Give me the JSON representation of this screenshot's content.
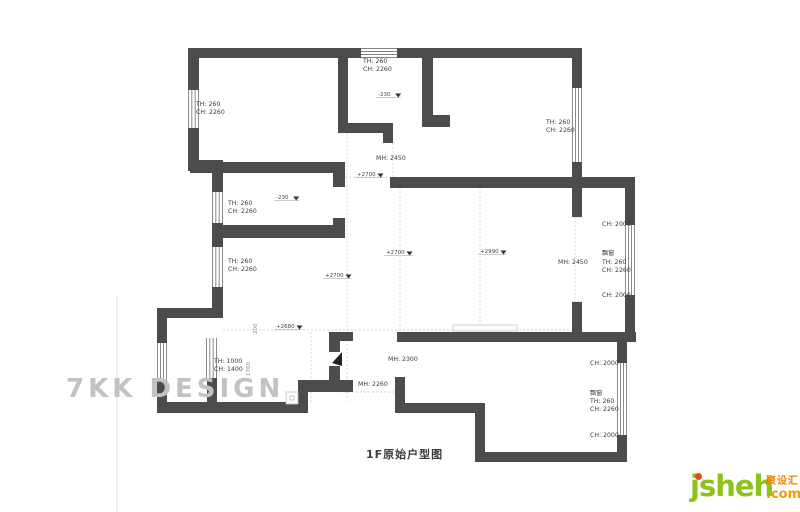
{
  "watermark": {
    "text": "7KK DESIGN"
  },
  "title": {
    "text": "1F原始户型图"
  },
  "logo": {
    "wordmark": "jsheh",
    "chinese": "聚设汇",
    "tld": ".com"
  },
  "floorplan": {
    "wall_color": "#4c4c4c",
    "walls": [
      [
        188,
        48,
        174,
        10
      ],
      [
        396,
        48,
        186,
        10
      ],
      [
        188,
        58,
        11,
        32
      ],
      [
        188,
        128,
        11,
        42
      ],
      [
        188,
        160,
        35,
        11
      ],
      [
        212,
        171,
        11,
        21
      ],
      [
        212,
        223,
        11,
        24
      ],
      [
        212,
        287,
        11,
        31
      ],
      [
        157,
        308,
        66,
        10
      ],
      [
        157,
        318,
        10,
        25
      ],
      [
        157,
        380,
        10,
        33
      ],
      [
        157,
        402,
        151,
        11
      ],
      [
        207,
        378,
        10,
        24
      ],
      [
        298,
        380,
        10,
        33
      ],
      [
        298,
        380,
        55,
        12
      ],
      [
        329,
        332,
        11,
        20
      ],
      [
        329,
        366,
        11,
        26
      ],
      [
        329,
        332,
        24,
        9
      ],
      [
        390,
        177,
        245,
        11
      ],
      [
        397,
        332,
        220,
        10
      ],
      [
        395,
        377,
        10,
        33
      ],
      [
        395,
        403,
        90,
        10
      ],
      [
        475,
        403,
        10,
        59
      ],
      [
        475,
        452,
        152,
        10
      ],
      [
        617,
        342,
        10,
        21
      ],
      [
        617,
        435,
        10,
        27
      ],
      [
        625,
        188,
        10,
        37
      ],
      [
        625,
        295,
        10,
        47
      ],
      [
        617,
        332,
        19,
        10
      ],
      [
        572,
        58,
        10,
        30
      ],
      [
        572,
        162,
        10,
        26
      ],
      [
        572,
        188,
        10,
        29
      ],
      [
        572,
        302,
        10,
        30
      ],
      [
        338,
        55,
        10,
        68
      ],
      [
        338,
        123,
        55,
        10
      ],
      [
        383,
        133,
        10,
        10
      ],
      [
        422,
        58,
        11,
        69
      ],
      [
        422,
        115,
        28,
        12
      ],
      [
        190,
        162,
        155,
        11
      ],
      [
        215,
        225,
        130,
        13
      ],
      [
        333,
        173,
        12,
        14
      ],
      [
        333,
        218,
        12,
        20
      ]
    ],
    "windows": [
      [
        361,
        48,
        36,
        10,
        "h",
        4
      ],
      [
        188,
        90,
        11,
        38,
        "v",
        4
      ],
      [
        212,
        192,
        11,
        31,
        "v",
        4
      ],
      [
        212,
        247,
        11,
        40,
        "v",
        4
      ],
      [
        572,
        88,
        10,
        74,
        "v",
        4
      ],
      [
        625,
        225,
        10,
        70,
        "v",
        4
      ],
      [
        617,
        363,
        10,
        72,
        "v",
        4
      ],
      [
        157,
        343,
        10,
        37,
        "v",
        4
      ],
      [
        206,
        338,
        11,
        40,
        "v",
        4
      ]
    ],
    "dashed_lines": [
      [
        347,
        133,
        347,
        331
      ],
      [
        400,
        188,
        400,
        331
      ],
      [
        480,
        188,
        480,
        330
      ],
      [
        575,
        217,
        575,
        302
      ],
      [
        311,
        332,
        311,
        402
      ],
      [
        223,
        330,
        572,
        330
      ],
      [
        337,
        177,
        390,
        177
      ],
      [
        340,
        392,
        397,
        392
      ],
      [
        347,
        332,
        347,
        401
      ],
      [
        393,
        143,
        393,
        177
      ]
    ],
    "thin_lines": [
      [
        572,
        217,
        582,
        217
      ],
      [
        572,
        302,
        582,
        302
      ],
      [
        625,
        225,
        635,
        225
      ],
      [
        625,
        295,
        635,
        295
      ],
      [
        617,
        363,
        627,
        363
      ],
      [
        617,
        435,
        627,
        435
      ],
      [
        117,
        295,
        117,
        512
      ]
    ],
    "fixture_rects": [
      [
        453,
        325,
        64,
        6
      ],
      [
        286,
        392,
        12,
        12
      ]
    ],
    "fixture_circles": [
      [
        292,
        398,
        2.2
      ]
    ],
    "door_leaf": "342,352 342,366 332,363",
    "labels": [
      {
        "x": 196,
        "y": 106,
        "t": "TH: 260"
      },
      {
        "x": 196,
        "y": 114,
        "t": "CH: 2260"
      },
      {
        "x": 363,
        "y": 63,
        "t": "TH: 260"
      },
      {
        "x": 363,
        "y": 71,
        "t": "CH: 2260"
      },
      {
        "x": 546,
        "y": 124,
        "t": "TH: 260"
      },
      {
        "x": 546,
        "y": 132,
        "t": "CH: 2260"
      },
      {
        "x": 228,
        "y": 205,
        "t": "TH: 260"
      },
      {
        "x": 228,
        "y": 213,
        "t": "CH: 2260"
      },
      {
        "x": 228,
        "y": 263,
        "t": "TH: 260"
      },
      {
        "x": 228,
        "y": 271,
        "t": "CH: 2260"
      },
      {
        "x": 214,
        "y": 363,
        "t": "TH: 1000"
      },
      {
        "x": 214,
        "y": 371,
        "t": "CH: 1400"
      },
      {
        "x": 602,
        "y": 226,
        "t": "CH: 2000"
      },
      {
        "x": 602,
        "y": 255,
        "t": "飘窗"
      },
      {
        "x": 602,
        "y": 264,
        "t": "TH: 260"
      },
      {
        "x": 602,
        "y": 272,
        "t": "CH: 2260"
      },
      {
        "x": 602,
        "y": 297,
        "t": "CH: 2000"
      },
      {
        "x": 590,
        "y": 365,
        "t": "CH: 2000"
      },
      {
        "x": 590,
        "y": 395,
        "t": "飘窗"
      },
      {
        "x": 590,
        "y": 403,
        "t": "TH: 260"
      },
      {
        "x": 590,
        "y": 411,
        "t": "CH: 2260"
      },
      {
        "x": 590,
        "y": 437,
        "t": "CH: 2000"
      },
      {
        "x": 376,
        "y": 160,
        "t": "MH: 2450"
      },
      {
        "x": 558,
        "y": 264,
        "t": "MH: 2450"
      },
      {
        "x": 388,
        "y": 361,
        "t": "MH: 2300"
      },
      {
        "x": 358,
        "y": 386,
        "t": "MH: 2260"
      }
    ],
    "rotated_labels": [
      {
        "x": 257,
        "y": 334,
        "t": "200"
      },
      {
        "x": 250,
        "y": 376,
        "t": "1760"
      }
    ],
    "elevation_markers": [
      {
        "x": 378,
        "y": 96,
        "t": "-230"
      },
      {
        "x": 276,
        "y": 199,
        "t": "-230"
      },
      {
        "x": 357,
        "y": 176,
        "t": "+2700"
      },
      {
        "x": 325,
        "y": 277,
        "t": "+2700"
      },
      {
        "x": 386,
        "y": 254,
        "t": "+2700"
      },
      {
        "x": 480,
        "y": 253,
        "t": "+2990"
      },
      {
        "x": 276,
        "y": 328,
        "t": "+2680"
      }
    ]
  }
}
